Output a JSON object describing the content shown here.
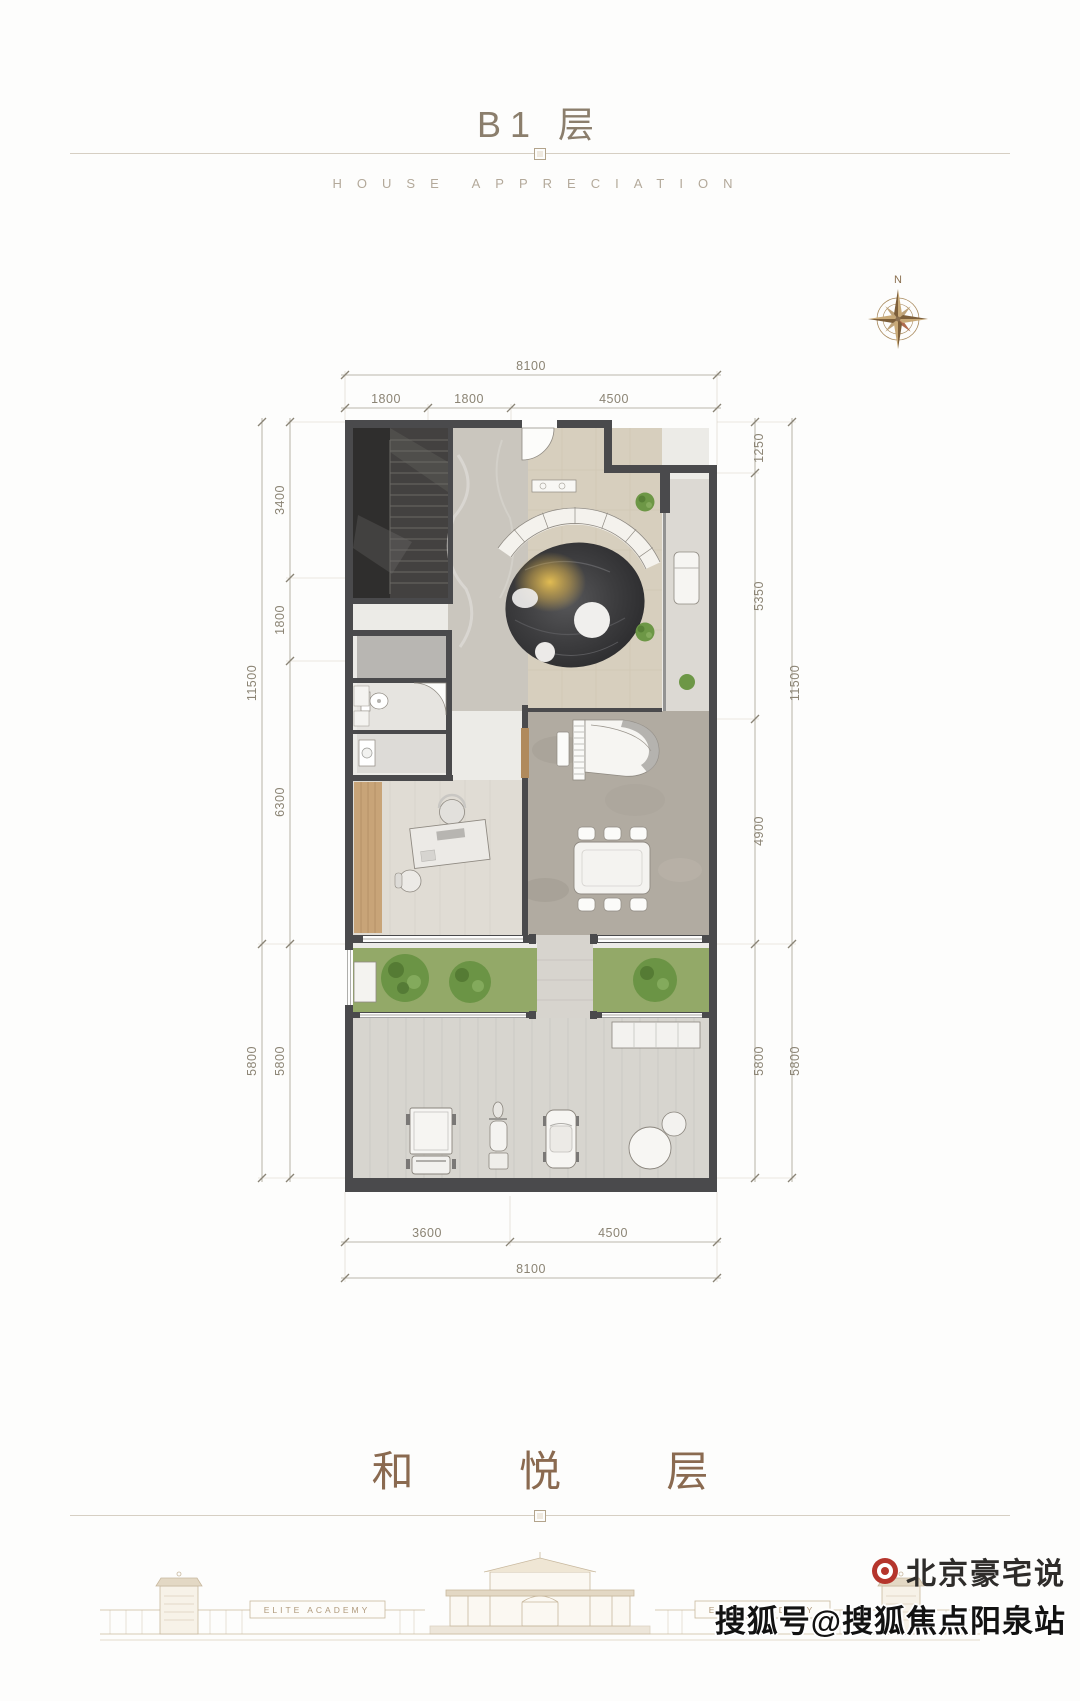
{
  "header": {
    "title": "B1 层",
    "subtitle": "HOUSE APPRECIATION"
  },
  "compass": {
    "north": "N"
  },
  "dims": {
    "top_total": "8100",
    "top_seg1": "1800",
    "top_seg2": "1800",
    "top_seg3": "4500",
    "left_outer_1": "11500",
    "left_outer_2": "5800",
    "left_inner_1": "3400",
    "left_inner_2": "1800",
    "left_inner_3": "6300",
    "left_inner_4": "5800",
    "right_inner_1": "1250",
    "right_inner_2": "5350",
    "right_inner_3": "4900",
    "right_inner_4": "5800",
    "right_outer_1": "11500",
    "right_outer_2": "5800",
    "bottom_seg1": "3600",
    "bottom_seg2": "4500",
    "bottom_total": "8100"
  },
  "footer": {
    "floor_name": "和 悦 层",
    "gate_label_left": "ELITE ACADEMY",
    "gate_label_right": "ELITE ACADEMY"
  },
  "watermark": {
    "brand": "北京豪宅说",
    "account": "搜狐号@搜狐焦点阳泉站"
  },
  "colors": {
    "wall": "#4a4a4c",
    "title_brown": "#8b7e6c",
    "calligraphy_brown": "#8a6a50",
    "dim_text": "#8b8474",
    "plant_green": "#6d9746",
    "rug_dark": "#39393b",
    "rug_glow": "#e2b94f",
    "elevation_tan": "#c8b89e",
    "logo_red": "#b5352c"
  }
}
